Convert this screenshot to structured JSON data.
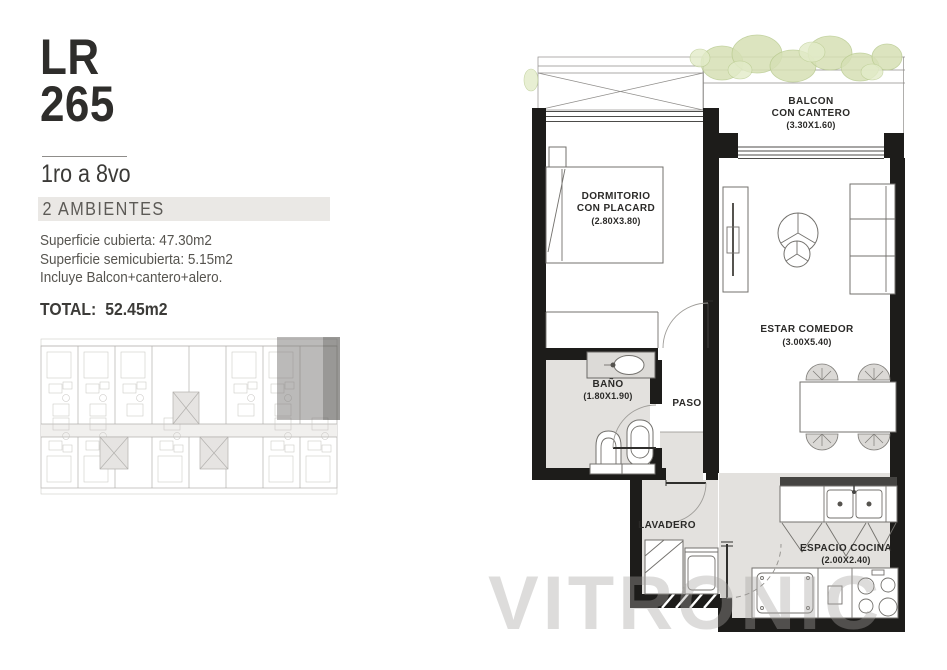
{
  "sidebar": {
    "code_line1": "LR",
    "code_line2": "265",
    "floors": "1ro a 8vo",
    "badge": "2 AMBIENTES",
    "surface_lines": [
      "Superficie cubierta: 47.30m2",
      "Superficie semicubierta: 5.15m2",
      "Incluye Balcon+cantero+alero."
    ],
    "total_label": "TOTAL:",
    "total_value": "52.45m2"
  },
  "plan": {
    "rooms": {
      "balcon": {
        "line1": "BALCON",
        "line2": "CON CANTERO",
        "dims": "(3.30X1.60)"
      },
      "dormitorio": {
        "line1": "DORMITORIO",
        "line2": "CON PLACARD",
        "dims": "(2.80X3.80)"
      },
      "estar": {
        "line1": "ESTAR COMEDOR",
        "dims": "(3.00X5.40)"
      },
      "bano": {
        "line1": "BAÑO",
        "dims": "(1.80X1.90)"
      },
      "paso": {
        "line1": "PASO"
      },
      "lavadero": {
        "line1": "LAVADERO"
      },
      "cocina": {
        "line1": "ESPACIO COCINA",
        "dims": "(2.00X2.40)"
      }
    },
    "watermark": "VITRONIC"
  },
  "colors": {
    "wall": "#1d1c1a",
    "floor-gray": "#e3e1de",
    "badge-bg": "#eae8e5",
    "text-dark": "#2e2d2b",
    "text-body": "#56544f",
    "plant-fill": "#d6e0b5",
    "plant-stroke": "#b9cb90",
    "keyplan-line": "#b2b0ad",
    "highlight": "#5f5e5c"
  }
}
